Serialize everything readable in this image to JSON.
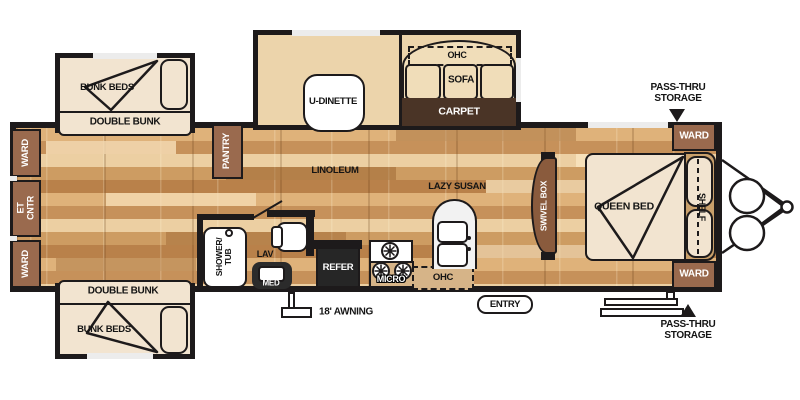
{
  "title": "Travel trailer floor plan",
  "colors": {
    "wall": "#1d1a1b",
    "cabinet_brown": "#9a6a4e",
    "carpet_brown": "#4a3426",
    "floor_tan": "#cd9c62",
    "furniture_cream": "#f2e4d0",
    "bench_tan": "#ecd4ab",
    "overhead_tan": "#d6b488",
    "refer_dark": "#262626",
    "swivel_brown": "#8a5b3d",
    "shelf_tan": "#c9a06b"
  },
  "labels": {
    "slide_top": {
      "bunk_beds": "BUNK BEDS",
      "double_bunk": "DOUBLE BUNK"
    },
    "slide_dinette": {
      "u_dinette": "U-DINETTE",
      "ohc": "OHC",
      "sofa": "SOFA",
      "carpet": "CARPET"
    },
    "left_wall": {
      "ward_top": "WARD",
      "et_cntr": "ET\nCNTR",
      "ward_bottom": "WARD"
    },
    "pantry": "PANTRY",
    "linoleum": "LINOLEUM",
    "bath": {
      "shower_tub": "SHOWER/\nTUB",
      "lav": "LAV",
      "med": "MED"
    },
    "kitchen": {
      "refer": "REFER",
      "micro": "MICRO",
      "ohc": "OHC",
      "lazy_susan": "LAZY SUSAN"
    },
    "swivel_box": "SWIVEL BOX",
    "bedroom": {
      "queen_bed": "QUEEN BED",
      "shelf": "SHELF",
      "ward_top": "WARD",
      "ward_bottom": "WARD"
    },
    "slide_bottom": {
      "double_bunk": "DOUBLE BUNK",
      "bunk_beds": "BUNK BEDS"
    },
    "exterior": {
      "entry": "ENTRY",
      "awning": "18' AWNING",
      "pass_thru_top": "PASS-THRU\nSTORAGE",
      "pass_thru_bottom": "PASS-THRU\nSTORAGE"
    }
  }
}
